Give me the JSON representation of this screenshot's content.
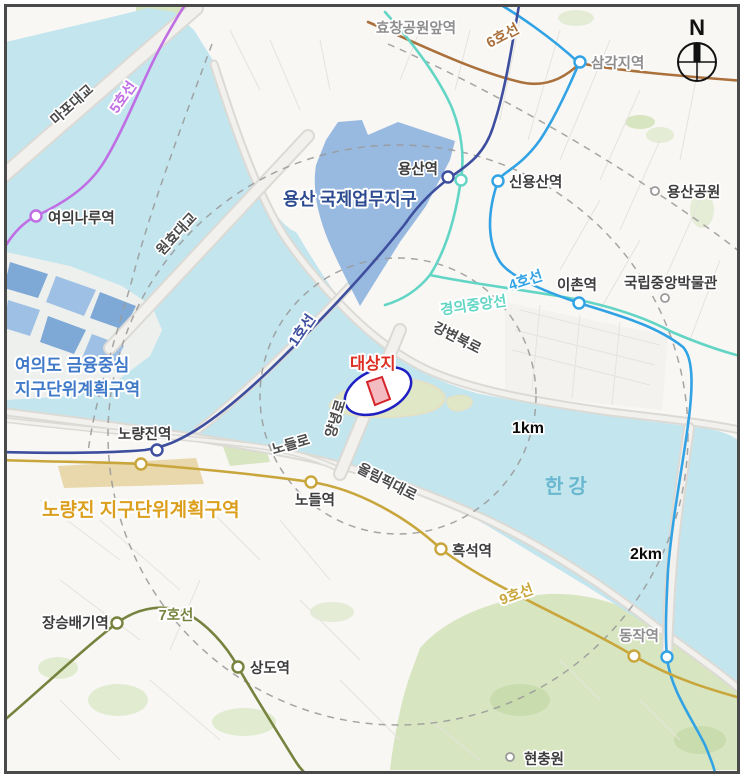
{
  "compass": {
    "label": "N"
  },
  "scale_rings": {
    "inner_label": "1km",
    "outer_label": "2km"
  },
  "site": {
    "label": "대상지",
    "label_color": "#de2f23",
    "outline_color": "#1f1fc4",
    "band_border": "#d6242b",
    "band_fill": "#f4bcc1"
  },
  "river": {
    "name": "한강",
    "label_color": "#69b8d0",
    "water_color": "#c3e5ee"
  },
  "districts": {
    "yongsan_ibd": {
      "name": "용산 국제업무지구",
      "color": "#2b4a8f",
      "fill": "#92b5de"
    },
    "yeouido": {
      "name_line1": "여의도  금융중심",
      "name_line2": "지구단위계획구역",
      "color": "#3f79c8"
    },
    "noryangjin": {
      "name": "노량진 지구단위계획구역",
      "color": "#dc9f1d",
      "fill": "#e7d4a4"
    }
  },
  "lines": {
    "line1": {
      "name": "1호선",
      "color": "#3d4e9e"
    },
    "line4": {
      "name": "4호선",
      "color": "#31a3e5"
    },
    "line5": {
      "name": "5호선",
      "color": "#c06ee3"
    },
    "line6": {
      "name": "6호선",
      "color": "#aa713d"
    },
    "line7": {
      "name": "7호선",
      "color": "#76833f"
    },
    "line9": {
      "name": "9호선",
      "color": "#c9a63c"
    },
    "gyeongui": {
      "name": "경의중앙선",
      "color": "#63d5c5"
    }
  },
  "stations": {
    "hyochang": {
      "name": "효창공원앞역"
    },
    "samgakji": {
      "name": "삼각지역"
    },
    "yongsan": {
      "name": "용산역"
    },
    "sinyongsan": {
      "name": "신용산역"
    },
    "yeouinaru": {
      "name": "여의나루역"
    },
    "ichon": {
      "name": "이촌역"
    },
    "noryangjin": {
      "name": "노량진역"
    },
    "nodeul": {
      "name": "노들역"
    },
    "heukseok": {
      "name": "흑석역"
    },
    "dongjak": {
      "name": "동작역"
    },
    "jangseungbaegi": {
      "name": "장승배기역"
    },
    "sangdo": {
      "name": "상도역"
    }
  },
  "pois": {
    "yongsan_park": {
      "name": "용산공원"
    },
    "museum": {
      "name": "국립중앙박물관"
    },
    "hyeonchungwon": {
      "name": "현충원"
    }
  },
  "roads": {
    "mapo_bridge": {
      "name": "마포대교"
    },
    "wonhyo_bridge": {
      "name": "원효대교"
    },
    "gangbyeon": {
      "name": "강변북로"
    },
    "yangnyeong": {
      "name": "양녕로"
    },
    "nodeul_ro": {
      "name": "노들로"
    },
    "olympic": {
      "name": "올림픽대로"
    }
  }
}
